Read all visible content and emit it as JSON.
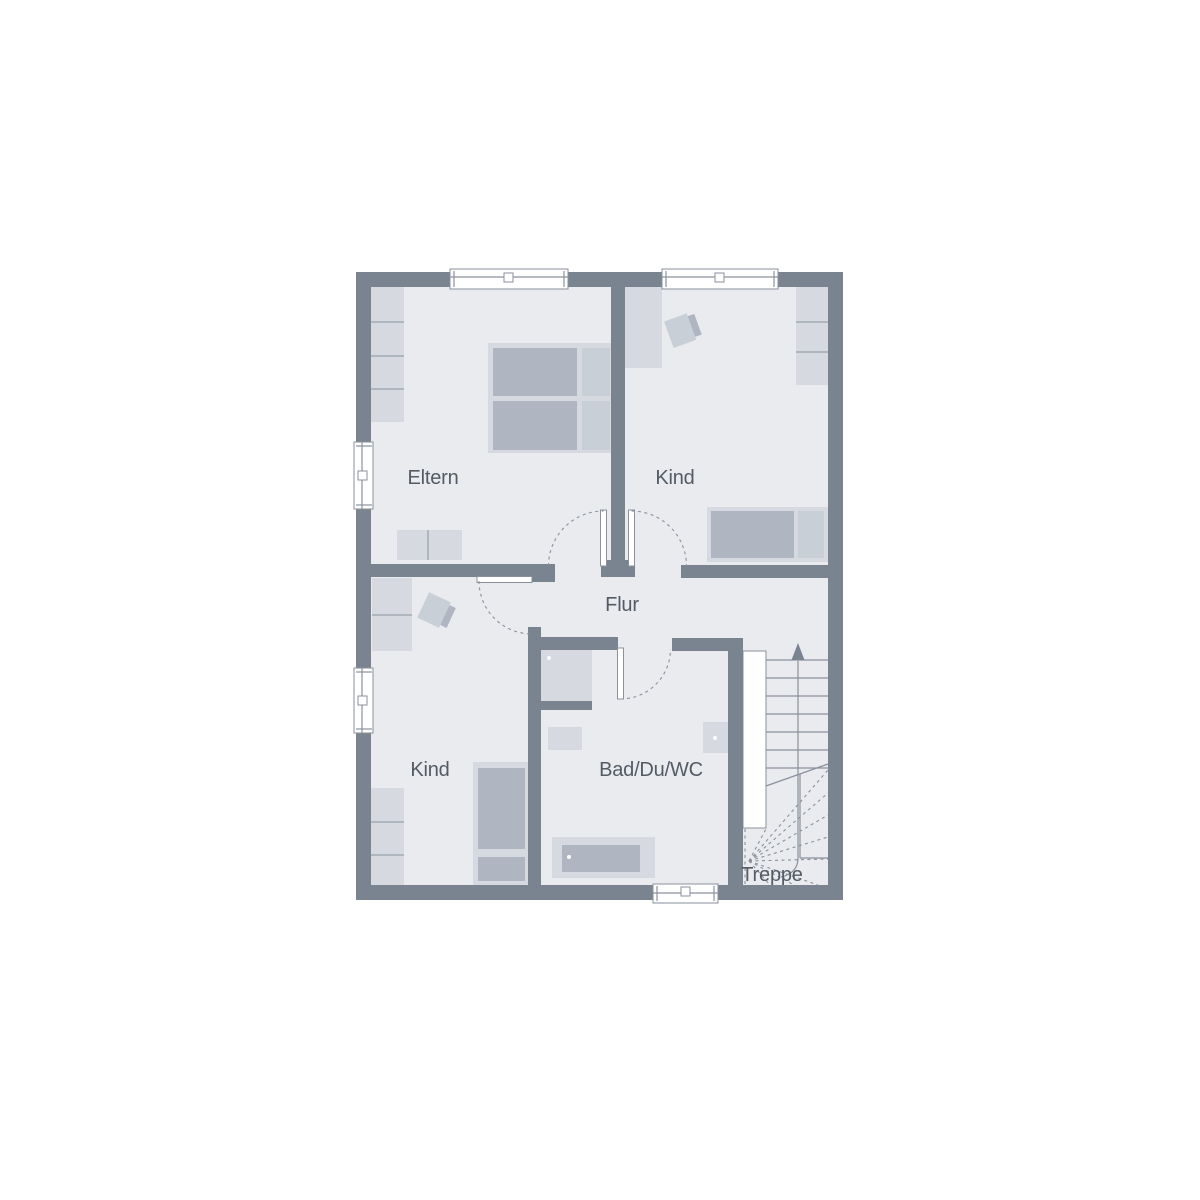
{
  "rooms": [
    {
      "id": "eltern",
      "label": "Eltern"
    },
    {
      "id": "kind-top",
      "label": "Kind"
    },
    {
      "id": "flur",
      "label": "Flur"
    },
    {
      "id": "kind-bottom",
      "label": "Kind"
    },
    {
      "id": "bad-du-wc",
      "label": "Bad/Du/WC"
    },
    {
      "id": "treppe",
      "label": "Treppe"
    }
  ],
  "stairs": {
    "walk_direction": "up"
  },
  "colors": {
    "wall": "#7A8390",
    "floor": "#E9EBEE",
    "furn_light": "#D6DAE0",
    "furn_medium": "#C9CFD7",
    "furn_dark": "#AFB6C1",
    "line": "#8A919C",
    "text": "#545B64",
    "window": "#FFFFFF"
  }
}
